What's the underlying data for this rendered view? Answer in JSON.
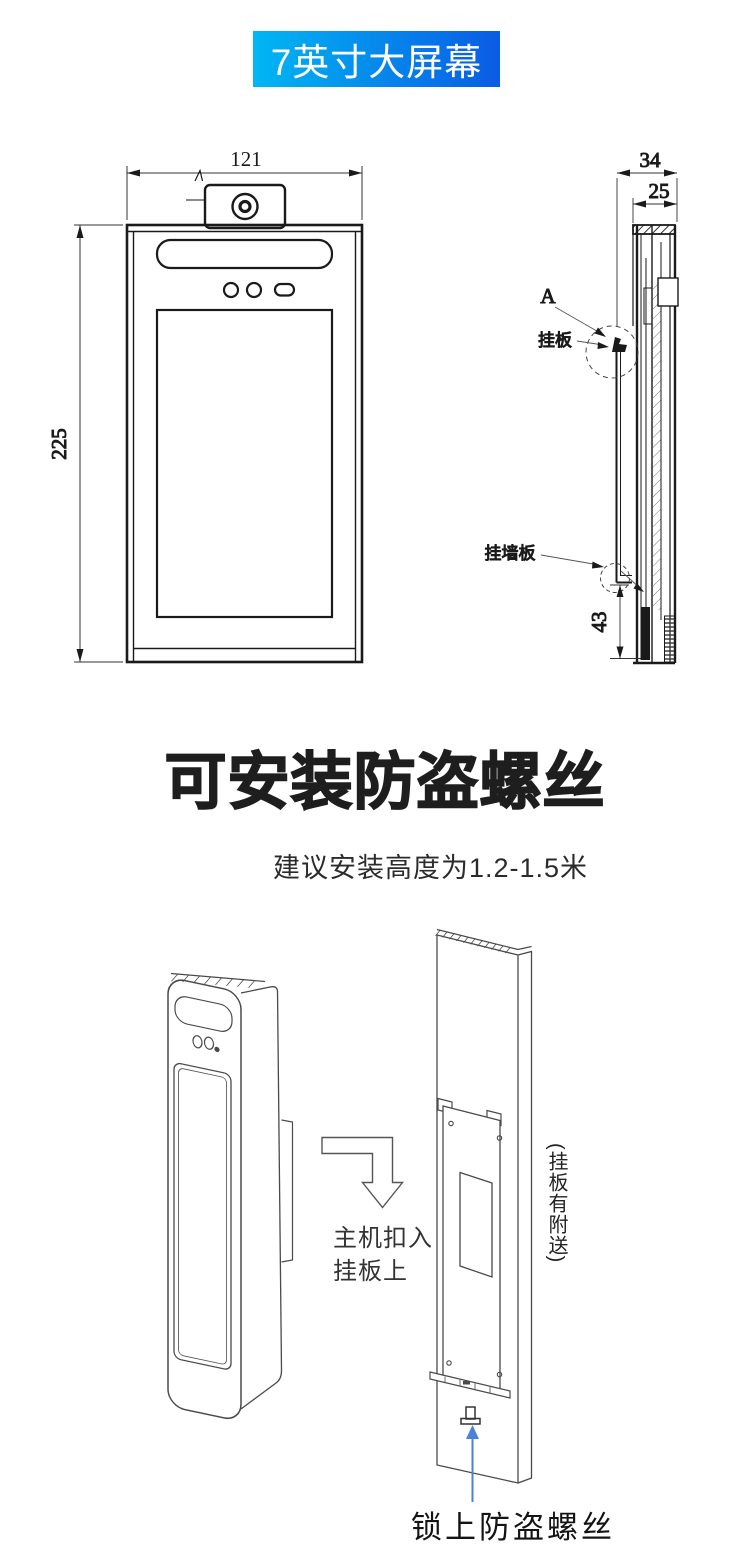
{
  "banner": {
    "text": "7英寸大屏幕"
  },
  "drawings": {
    "front_width": "121",
    "front_height": "225",
    "side_depth_total": "34",
    "side_depth_body": "25",
    "side_bottom_offset": "43",
    "detail_marker": "A",
    "hang_plate_label": "挂板",
    "wall_plate_label": "挂墙板"
  },
  "section": {
    "title": "可安装防盗螺丝",
    "subtitle": "建议安装高度为1.2-1.5米"
  },
  "install": {
    "step_note_line1": "主机扣入",
    "step_note_line2": "挂板上",
    "included_note": "(挂板有附送)",
    "screw_note": "锁上防盗螺丝"
  },
  "colors": {
    "banner_gradient_start": "#00b7f3",
    "banner_gradient_end": "#0b5be4",
    "pointer_arrow_blue": "#4a82d8",
    "line_black": "#1a1a1a",
    "line_gray": "#4a4a4a"
  }
}
